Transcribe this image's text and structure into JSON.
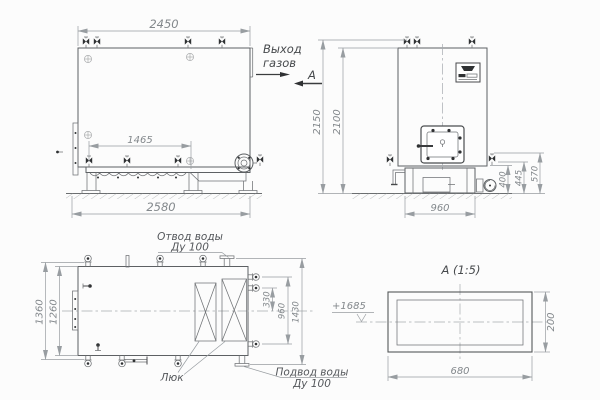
{
  "side": {
    "dim_top": "2450",
    "dim_grate": "1465",
    "dim_overall": "2580",
    "gas_outlet_line1": "Выход",
    "gas_outlet_line2": "газов"
  },
  "front": {
    "view_marker": "А",
    "dim_height_overall": "2150",
    "dim_height_body": "2100",
    "dim_base": "960",
    "dim_right_1": "400",
    "dim_right_2": "445",
    "dim_right_3": "570"
  },
  "plan": {
    "dim_width_overall": "1360",
    "dim_width_body": "1260",
    "dim_right_1": "330",
    "dim_right_2": "960",
    "dim_right_3": "1430",
    "label_water_outlet_1": "Отвод воды",
    "label_water_outlet_2": "Ду 100",
    "label_hatch": "Люк",
    "label_water_inlet_1": "Подвод воды",
    "label_water_inlet_2": "Ду 100"
  },
  "detail": {
    "title": "А (1:5)",
    "elevation_mark": "+1685",
    "dim_height": "200",
    "dim_width": "680"
  },
  "colors": {
    "outline": "#5d6063",
    "dimension": "#989da1",
    "dark_fitting": "#2f3133",
    "background": "#fcfcfc"
  }
}
